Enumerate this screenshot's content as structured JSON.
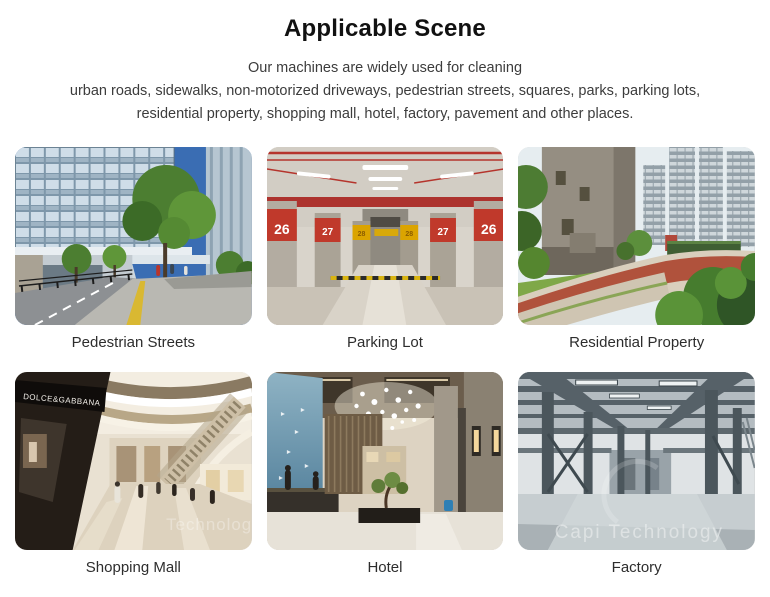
{
  "page": {
    "title": "Applicable Scene",
    "description": {
      "line1": "Our machines are widely used for cleaning",
      "line2": "urban roads, sidewalks, non-motorized driveways, pedestrian streets, squares, parks, parking lots,",
      "line3": "residential property, shopping mall, hotel, factory, pavement and other places."
    }
  },
  "scenes": [
    {
      "caption": "Pedestrian Streets"
    },
    {
      "caption": "Parking Lot"
    },
    {
      "caption": "Residential Property"
    },
    {
      "caption": "Shopping Mall"
    },
    {
      "caption": "Hotel"
    },
    {
      "caption": "Factory"
    }
  ],
  "photo_details": {
    "parking_pillar_numbers": [
      "26",
      "27",
      "28",
      "28",
      "27",
      "26"
    ],
    "mall_store_sign": "DOLCE&GABBANA",
    "mall_watermark_fragment": "Technology",
    "factory_watermark": "Capi  Technology"
  },
  "colors": {
    "parking_red": "#b5342c",
    "parking_yellow": "#dba400",
    "jogging_path_red": "#b0523c",
    "tactile_strip_yellow": "#d9b832",
    "text_dark": "#2d2d2d"
  }
}
